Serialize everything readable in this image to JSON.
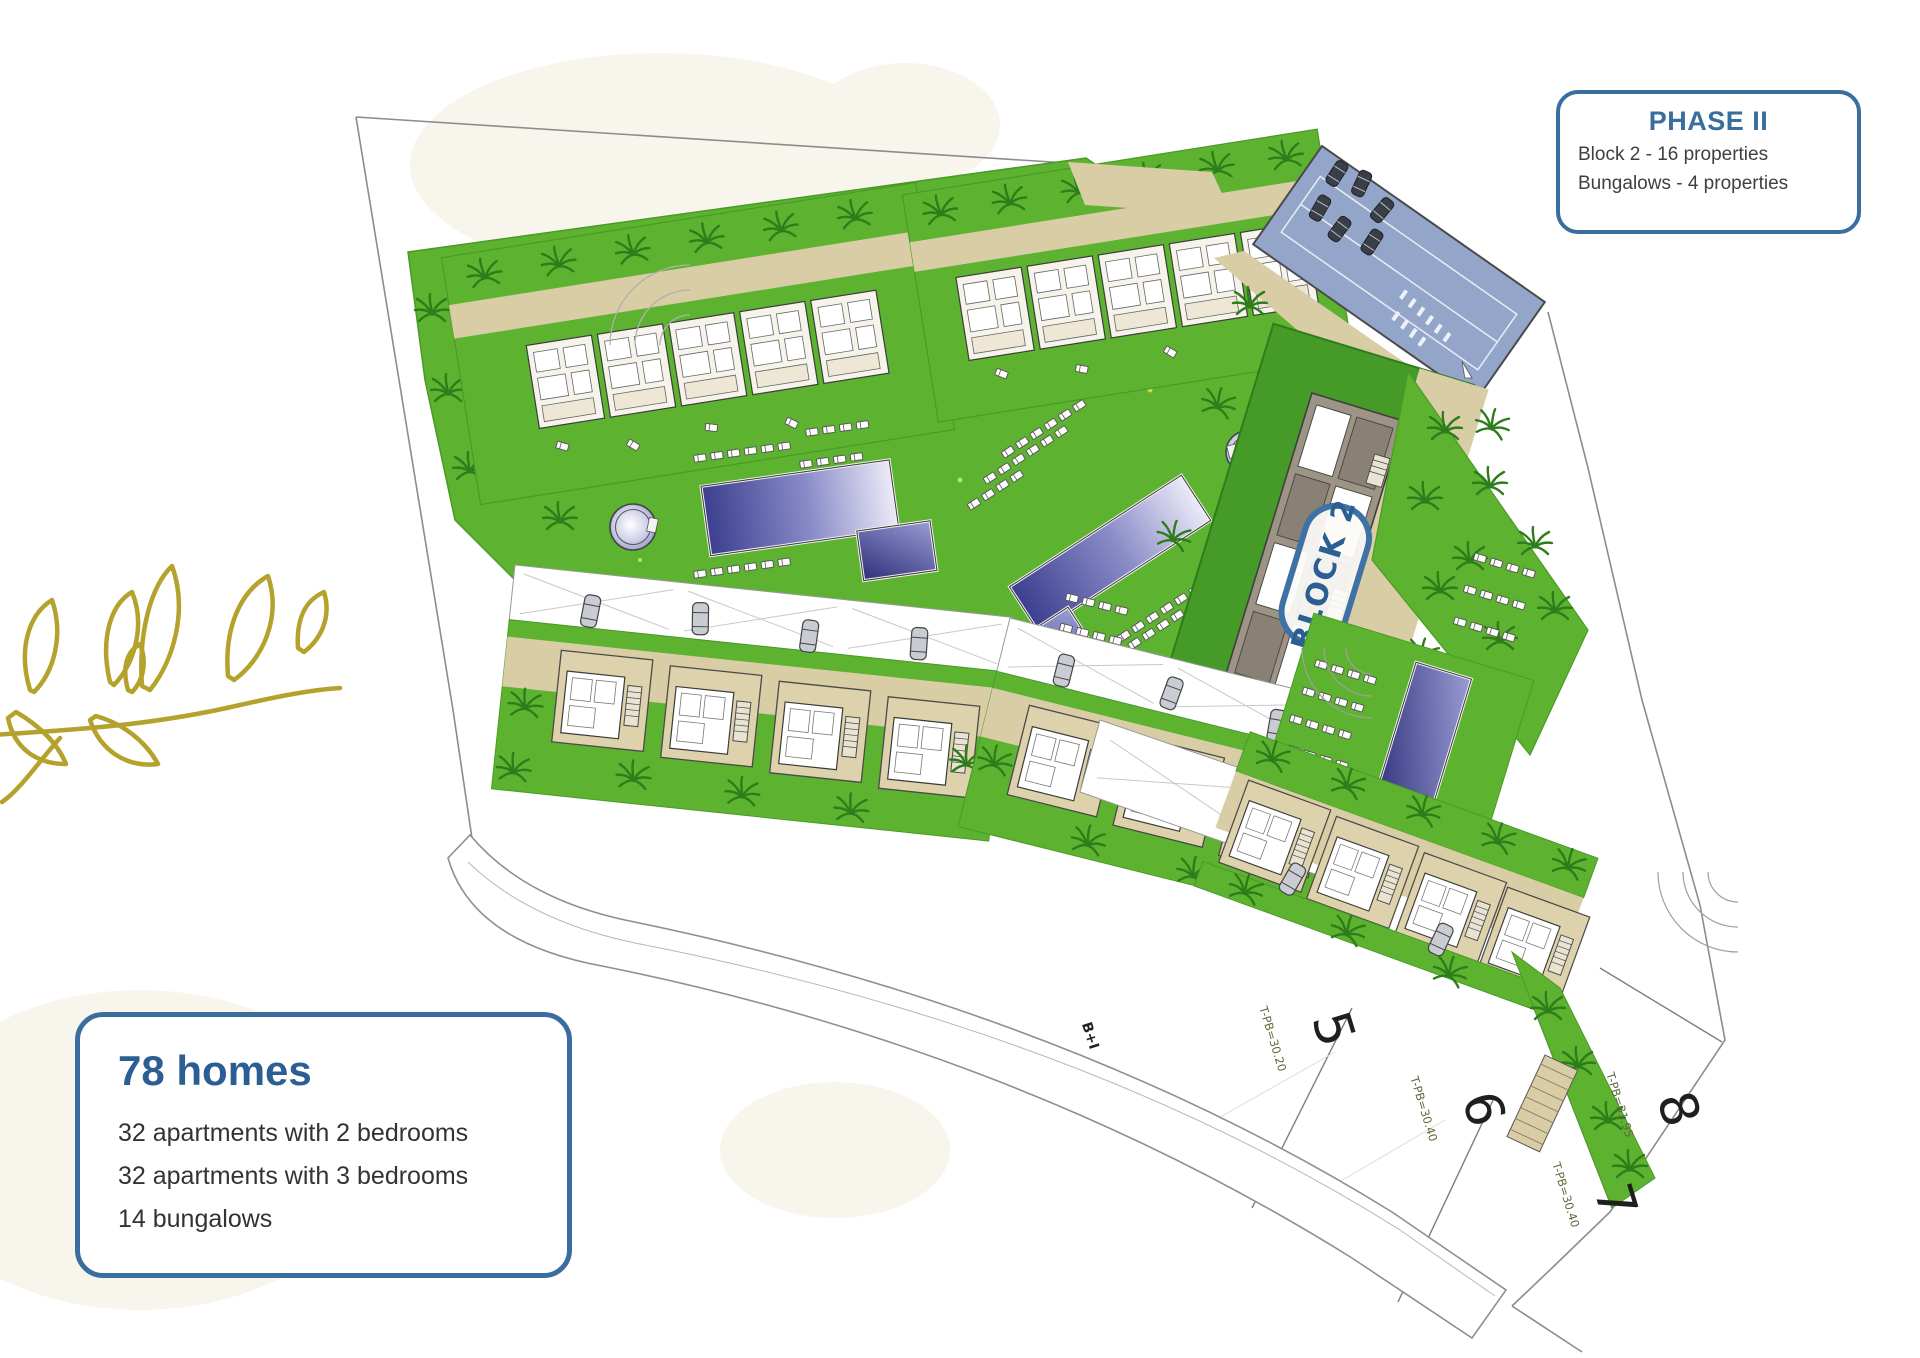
{
  "canvas": {
    "width": 1920,
    "height": 1358,
    "background": "#ffffff"
  },
  "phase_box": {
    "title": "PHASE II",
    "lines": [
      "Block 2 - 16 properties",
      "Bungalows - 4 properties"
    ],
    "border_color": "#3a6e9e",
    "title_color": "#3a6e9e",
    "text_color": "#3f3f3f"
  },
  "homes_box": {
    "title": "78 homes",
    "lines": [
      "32 apartments with 2 bedrooms",
      "32 apartments with 3 bedrooms",
      "14 bungalows"
    ],
    "border_color": "#3a6e9e",
    "title_color": "#2b5f94",
    "text_color": "#333333"
  },
  "site_plan": {
    "block_label": "BLOCK 2",
    "road_label": "B+I",
    "plots": [
      {
        "number": "5",
        "level_label": "T-PB=30.20"
      },
      {
        "number": "6",
        "level_label": "T-PB=30.40"
      },
      {
        "number": "7",
        "level_label": "T-PB=30.40"
      },
      {
        "number": "8",
        "level_label": "T-PB=31.95"
      }
    ],
    "colors": {
      "lawn": "#5db330",
      "lawn_dark": "#459a28",
      "palm": "#2e7d1b",
      "path_beige": "#d9cda6",
      "parking_blue": "#93a5c9",
      "pool_dark": "#3b3f8e",
      "pool_light": "#eceaf8",
      "accent_blue": "#3a6e9e",
      "branch_gold": "#b5a22c"
    }
  }
}
